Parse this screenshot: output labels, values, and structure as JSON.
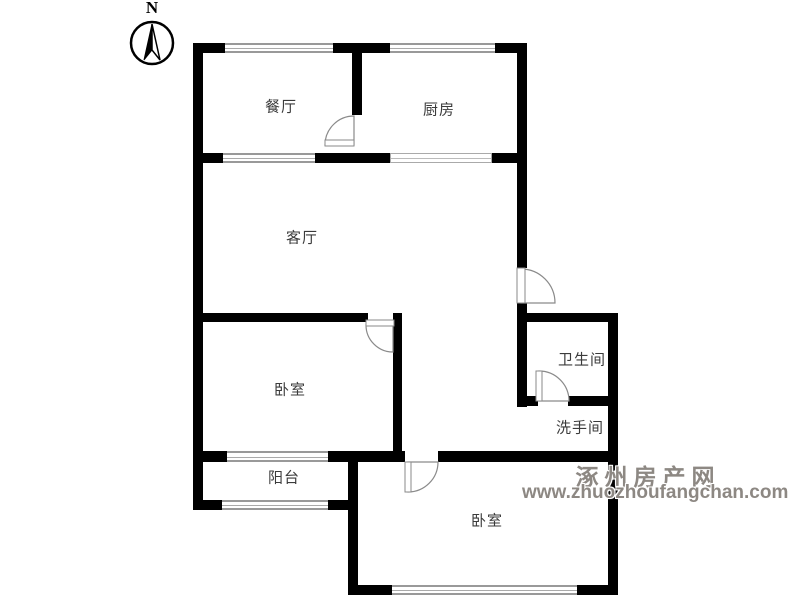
{
  "compass": {
    "label": "N"
  },
  "rooms": {
    "dining": {
      "label": "餐厅"
    },
    "kitchen": {
      "label": "厨房"
    },
    "living": {
      "label": "客厅"
    },
    "bathroom": {
      "label": "卫生间"
    },
    "washroom": {
      "label": "洗手间"
    },
    "bedroom_left": {
      "label": "卧室"
    },
    "balcony": {
      "label": "阳台"
    },
    "bedroom_bottom": {
      "label": "卧室"
    }
  },
  "watermark": {
    "site_name": "涿州房产网",
    "site_url": "www.zhuozhoufangchan.com"
  },
  "colors": {
    "wall": "#000000",
    "window_line": "#999999",
    "door_line": "#8a8a8a",
    "label_text": "#3b3b3b",
    "watermark_text": "#8d8883"
  }
}
